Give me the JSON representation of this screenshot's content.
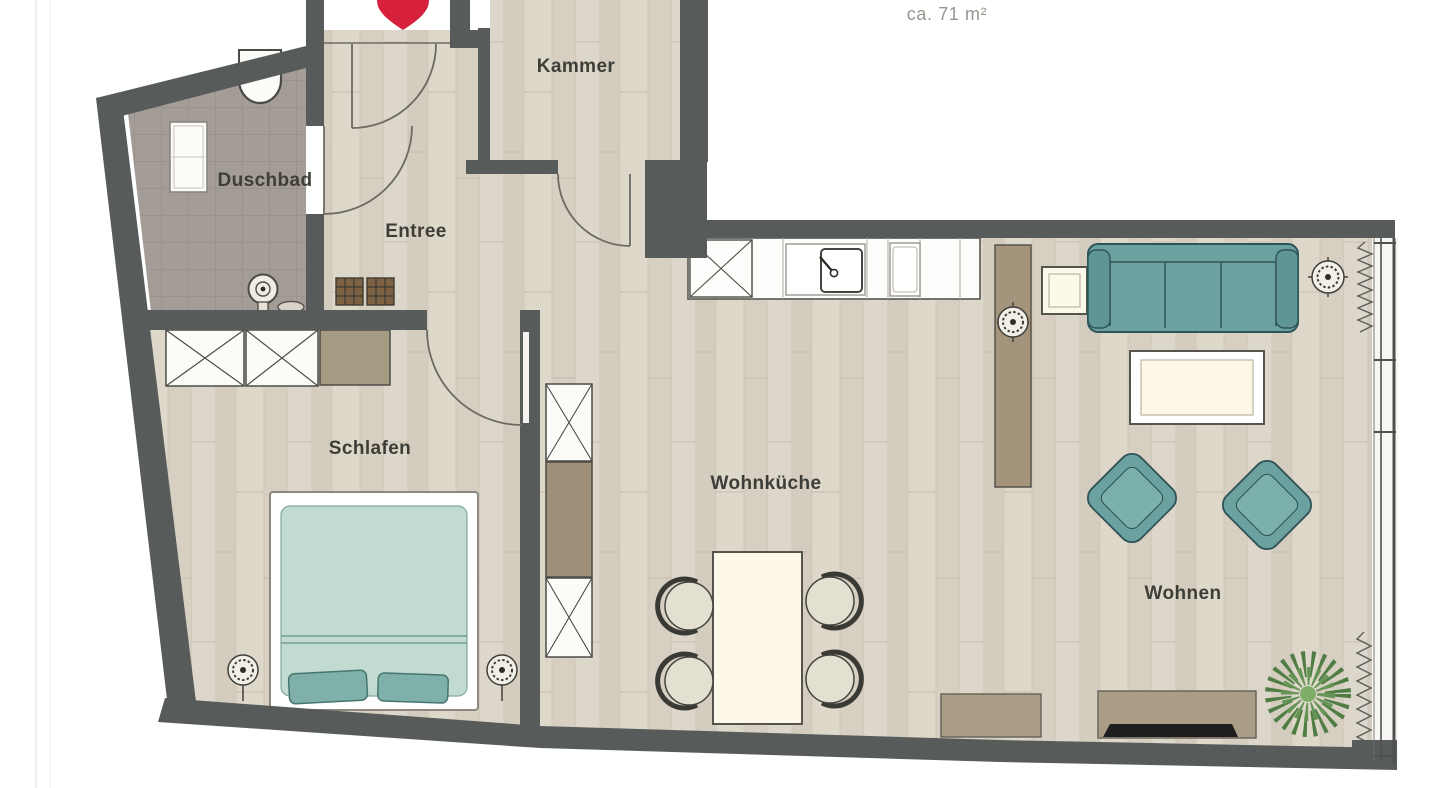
{
  "header": {
    "area_label": "ca. 71 m²"
  },
  "rooms": {
    "kammer": "Kammer",
    "duschbad": "Duschbad",
    "entree": "Entree",
    "schlafen": "Schlafen",
    "wohnkueche": "Wohnküche",
    "wohnen": "Wohnen"
  },
  "colors": {
    "wall": "#575c5a",
    "wood_floor": "#d9d2c6",
    "tile_floor": "#a49c96",
    "sofa_teal": "#6ba19f",
    "bed_mint": "#c2dbd0",
    "pillow_teal": "#7fb0aa",
    "cream_furniture": "#fdf8e8",
    "cabinet_brown": "#a3947b",
    "doormat_brown": "#7c6243",
    "marker_red": "#d6203c",
    "plant_green": "#4f7d43",
    "label_text": "#3e3e38"
  }
}
